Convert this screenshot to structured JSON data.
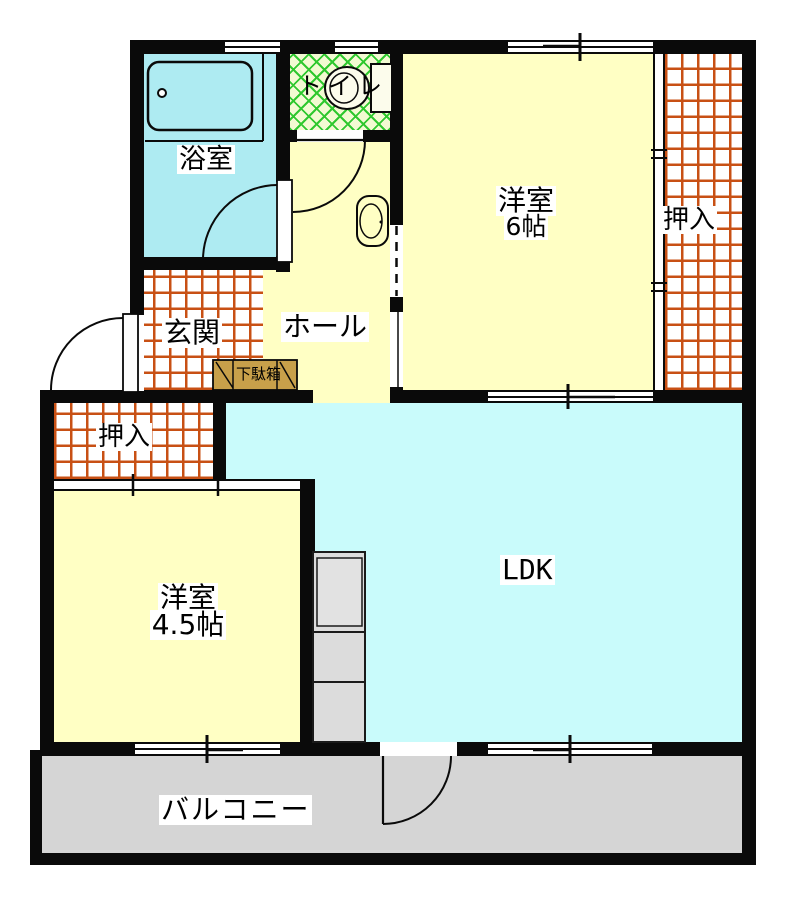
{
  "floorplan": {
    "type": "japanese-apartment-floor-plan",
    "rooms": {
      "bathroom": {
        "label": "浴室"
      },
      "toilet": {
        "label": "トイレ"
      },
      "bedroom_6": {
        "label": "洋室",
        "size": "6帖"
      },
      "closet_right": {
        "label": "押入"
      },
      "entrance": {
        "label": "玄関"
      },
      "hall": {
        "label": "ホール"
      },
      "shoe_cabinet": {
        "label": "下駄箱"
      },
      "closet_left": {
        "label": "押入"
      },
      "bedroom_45": {
        "label": "洋室",
        "size": "4.5帖"
      },
      "ldk": {
        "label": "LDK"
      },
      "balcony": {
        "label": "バルコニー"
      }
    },
    "fixtures": [
      "bathtub",
      "toilet-bowl",
      "washbasin",
      "kitchen-counter",
      "shoe-cabinet"
    ],
    "colors": {
      "wall": "#0A0A0A",
      "room_yellow": "#FFFFC4",
      "bathroom_cyan": "#AEEBF2",
      "ldk_cyan": "#C9FBFB",
      "balcony_gray": "#D5D5D5",
      "kitchen_gray": "#DCDCDC",
      "tile_grid_line": "#C85014",
      "toilet_lattice_line": "#2FC82F",
      "toilet_bg": "#F2FAD2",
      "shoe_cabinet_tan": "#C8A04A"
    }
  }
}
